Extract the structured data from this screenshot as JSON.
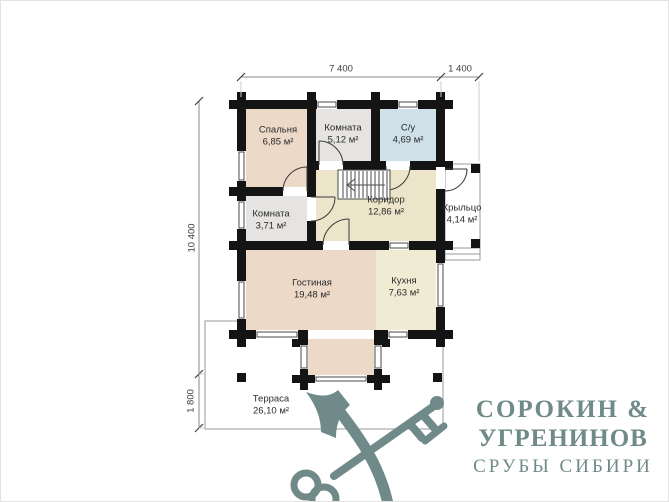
{
  "plan": {
    "dimensions": {
      "width_main": "7 400",
      "width_porch": "1 400",
      "height_main": "10 400",
      "height_terrace": "1 800"
    },
    "rooms": [
      {
        "name": "Спальня",
        "area": "6,85 м²"
      },
      {
        "name": "Комната",
        "area": "5,12 м²"
      },
      {
        "name": "С/у",
        "area": "4,69 м²"
      },
      {
        "name": "Комната",
        "area": "3,71 м²"
      },
      {
        "name": "Коридор",
        "area": "12,86 м²"
      },
      {
        "name": "Крыльцо",
        "area": "4,14 м²"
      },
      {
        "name": "Гостиная",
        "area": "19,48 м²"
      },
      {
        "name": "Кухня",
        "area": "7,63 м²"
      },
      {
        "name": "Терраса",
        "area": "26,10 м²"
      }
    ]
  },
  "logo": {
    "line1": "СОРОКИН &",
    "line2": "УГРЕНИНОВ",
    "line3": "СРУБЫ СИБИРИ"
  },
  "colors": {
    "wall": "#141414",
    "bedroom": "#ecd9c7",
    "small_room": "#e6e4e2",
    "bathroom": "#cfe0e8",
    "corridor": "#ece5c9",
    "living_room": "#edd9c8",
    "kitchen": "#f0ebd3",
    "logo": "#6f8a88"
  }
}
